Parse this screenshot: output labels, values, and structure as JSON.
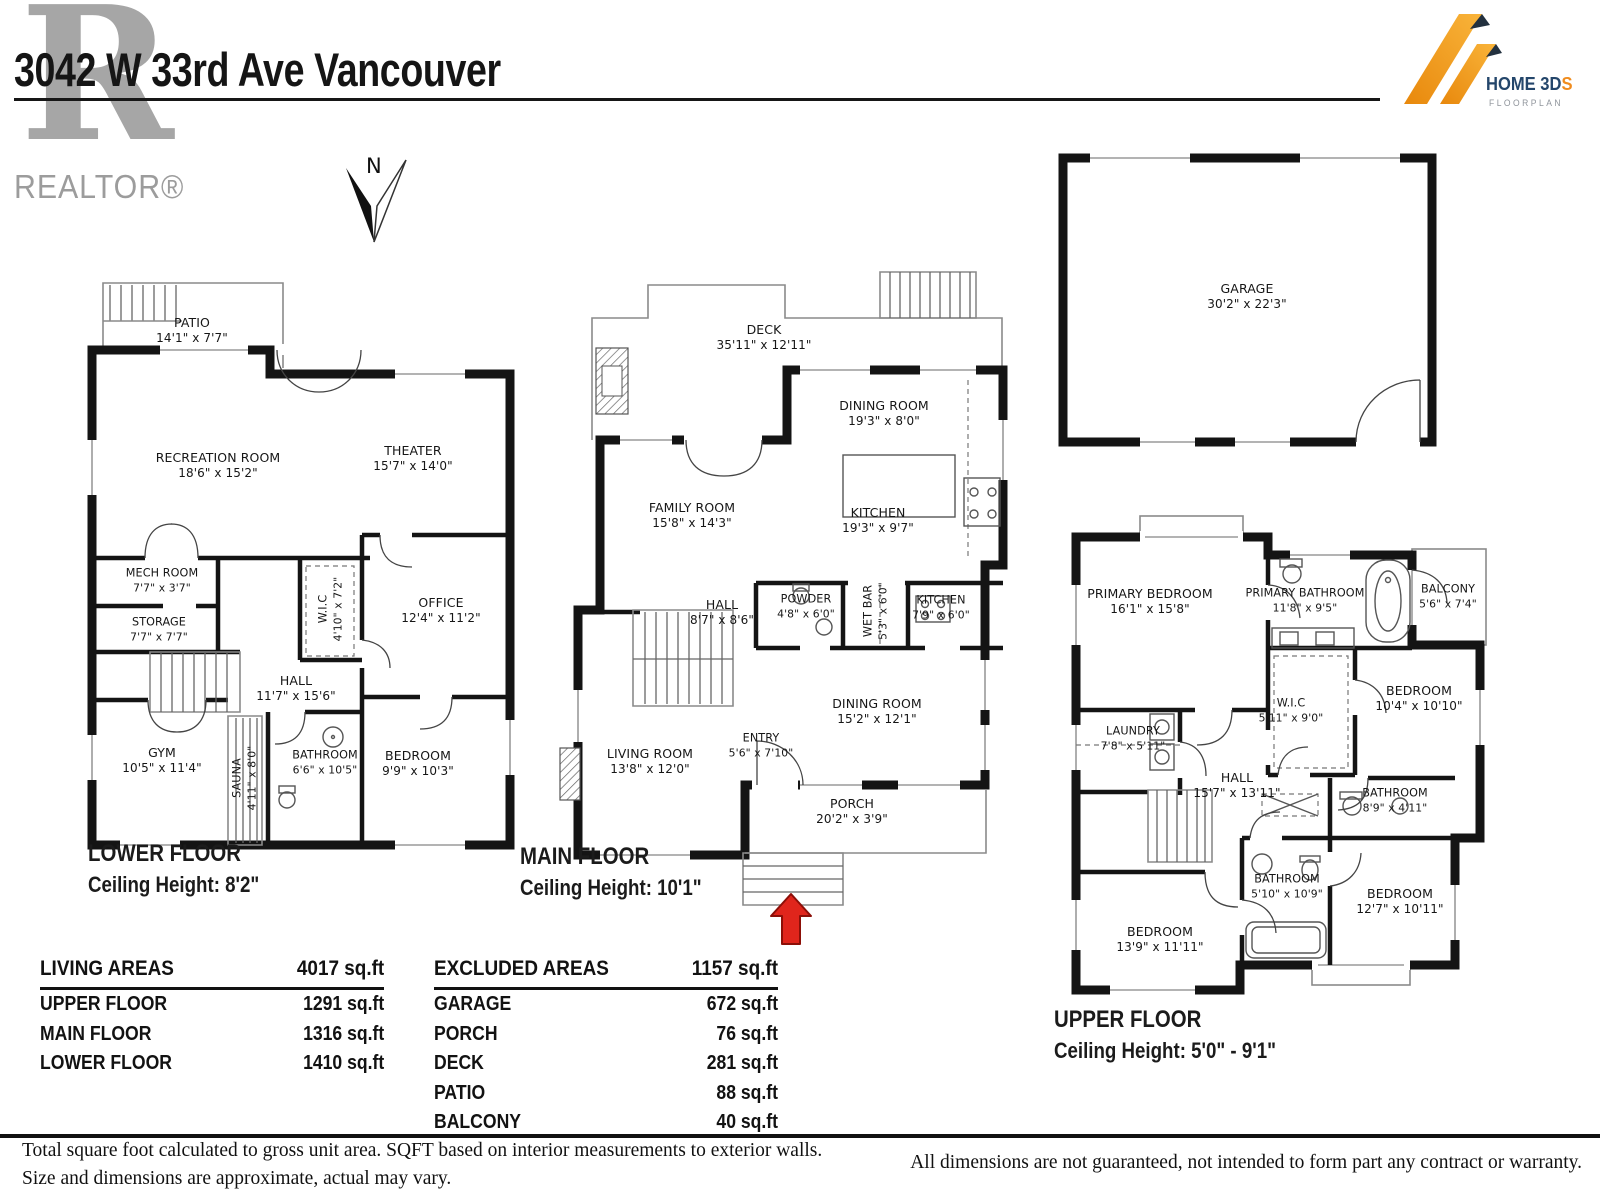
{
  "header": {
    "title": "3042 W 33rd Ave Vancouver",
    "realtor_letter": "R",
    "realtor_text": "REALTOR®",
    "brand": {
      "name": "HOME 3D",
      "accent": "S",
      "subtitle": "FLOORPLAN",
      "accent_color": "#f08c1e",
      "text_color": "#24466b"
    },
    "north_label": "N"
  },
  "floors": {
    "lower": {
      "label": "LOWER FLOOR",
      "ceiling": "Ceiling Height: 8'2\"",
      "rooms": [
        {
          "name": "PATIO",
          "dims": "14'1\" x 7'7\""
        },
        {
          "name": "RECREATION ROOM",
          "dims": "18'6\" x 15'2\""
        },
        {
          "name": "THEATER",
          "dims": "15'7\" x 14'0\""
        },
        {
          "name": "MECH ROOM",
          "dims": "7'7\" x 3'7\""
        },
        {
          "name": "STORAGE",
          "dims": "7'7\" x 7'7\""
        },
        {
          "name": "W.I.C",
          "dims": "4'10\" x 7'2\""
        },
        {
          "name": "OFFICE",
          "dims": "12'4\" x 11'2\""
        },
        {
          "name": "HALL",
          "dims": "11'7\" x 15'6\""
        },
        {
          "name": "GYM",
          "dims": "10'5\" x 11'4\""
        },
        {
          "name": "SAUNA",
          "dims": "4'11\" x 8'0\""
        },
        {
          "name": "BATHROOM",
          "dims": "6'6\" x 10'5\""
        },
        {
          "name": "BEDROOM",
          "dims": "9'9\" x 10'3\""
        }
      ]
    },
    "main": {
      "label": "MAIN FLOOR",
      "ceiling": "Ceiling Height: 10'1\"",
      "rooms": [
        {
          "name": "DECK",
          "dims": "35'11\" x 12'11\""
        },
        {
          "name": "DINING ROOM",
          "dims": "19'3\" x 8'0\""
        },
        {
          "name": "FAMILY ROOM",
          "dims": "15'8\" x 14'3\""
        },
        {
          "name": "KITCHEN",
          "dims": "19'3\" x 9'7\""
        },
        {
          "name": "HALL",
          "dims": "8'7\" x 8'6\""
        },
        {
          "name": "POWDER",
          "dims": "4'8\" x 6'0\""
        },
        {
          "name": "WET BAR",
          "dims": "5'3\" x 6'0\""
        },
        {
          "name": "KITCHEN",
          "dims": "7'9\" x 6'0\""
        },
        {
          "name": "DINING ROOM",
          "dims": "15'2\" x 12'1\""
        },
        {
          "name": "ENTRY",
          "dims": "5'6\" x 7'10\""
        },
        {
          "name": "LIVING ROOM",
          "dims": "13'8\" x 12'0\""
        },
        {
          "name": "PORCH",
          "dims": "20'2\" x 3'9\""
        }
      ]
    },
    "garage": {
      "rooms": [
        {
          "name": "GARAGE",
          "dims": "30'2\" x 22'3\""
        }
      ]
    },
    "upper": {
      "label": "UPPER FLOOR",
      "ceiling": "Ceiling Height: 5'0\" - 9'1\"",
      "rooms": [
        {
          "name": "PRIMARY BEDROOM",
          "dims": "16'1\" x 15'8\""
        },
        {
          "name": "PRIMARY BATHROOM",
          "dims": "11'8\" x 9'5\""
        },
        {
          "name": "BALCONY",
          "dims": "5'6\" x 7'4\""
        },
        {
          "name": "BEDROOM",
          "dims": "10'4\" x 10'10\""
        },
        {
          "name": "W.I.C",
          "dims": "5'11\" x 9'0\""
        },
        {
          "name": "LAUNDRY",
          "dims": "7'8\" x 5'11\""
        },
        {
          "name": "HALL",
          "dims": "15'7\" x 13'11\""
        },
        {
          "name": "BATHROOM",
          "dims": "8'9\" x 4'11\""
        },
        {
          "name": "BATHROOM",
          "dims": "5'10\" x 10'9\""
        },
        {
          "name": "BEDROOM",
          "dims": "12'7\" x 10'11\""
        },
        {
          "name": "BEDROOM",
          "dims": "13'9\" x 11'11\""
        }
      ]
    }
  },
  "tables": {
    "living": {
      "title": "LIVING AREAS",
      "total": "4017 sq.ft",
      "rows": [
        {
          "label": "UPPER FLOOR",
          "value": "1291 sq.ft"
        },
        {
          "label": "MAIN FLOOR",
          "value": "1316 sq.ft"
        },
        {
          "label": "LOWER FLOOR",
          "value": "1410 sq.ft"
        }
      ]
    },
    "excluded": {
      "title": "EXCLUDED AREAS",
      "total": "1157 sq.ft",
      "rows": [
        {
          "label": "GARAGE",
          "value": "672 sq.ft"
        },
        {
          "label": "PORCH",
          "value": "76 sq.ft"
        },
        {
          "label": "DECK",
          "value": "281 sq.ft"
        },
        {
          "label": "PATIO",
          "value": "88 sq.ft"
        },
        {
          "label": "BALCONY",
          "value": "40 sq.ft"
        }
      ]
    }
  },
  "footer": {
    "left_line1": "Total square foot calculated to gross unit area. SQFT based on interior measurements to exterior walls.",
    "left_line2": "Size and dimensions are approximate, actual may vary.",
    "right": "All dimensions are not guaranteed, not intended to form part any contract or warranty."
  }
}
